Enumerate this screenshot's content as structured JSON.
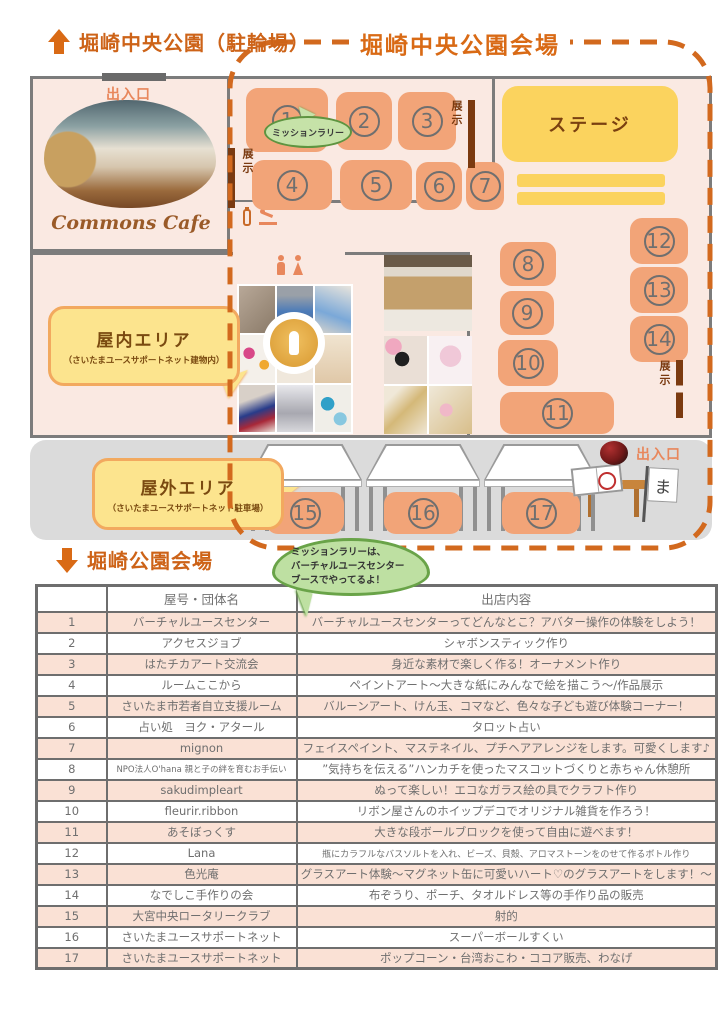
{
  "page": {
    "top_heading": "堀崎中央公園（駐輪場）",
    "map_title": "堀崎中央公園会場",
    "bottom_heading": "堀崎公園会場"
  },
  "map": {
    "entrance_label": "出入口",
    "exit_label": "出入口",
    "cafe_label": "Commons Cafe",
    "stage_label": "ステージ",
    "exhibit_label": "展示",
    "mission_bubble": "ミッションラリー",
    "indoor_bubble": {
      "title": "屋内エリア",
      "subtitle": "（さいたまユースサポートネット建物内）"
    },
    "outdoor_bubble": {
      "title": "屋外エリア",
      "subtitle": "（さいたまユースサポートネット駐車場）"
    },
    "flag_char": "ま",
    "booths": [
      "1",
      "2",
      "3",
      "4",
      "5",
      "6",
      "7",
      "8",
      "9",
      "10",
      "11",
      "12",
      "13",
      "14",
      "15",
      "16",
      "17"
    ]
  },
  "info_bubble": {
    "lines": [
      "ミッションラリーは、",
      "バーチャルユースセンター",
      "ブースでやってるよ！"
    ]
  },
  "table": {
    "headers": [
      "",
      "屋号・団体名",
      "出店内容"
    ],
    "rows": [
      {
        "no": "1",
        "name": "バーチャルユースセンター",
        "content": "バーチャルユースセンターってどんなとこ？アバター操作の体験をしよう！"
      },
      {
        "no": "2",
        "name": "アクセスジョブ",
        "content": "シャボンスティック作り"
      },
      {
        "no": "3",
        "name": "はたチカアート交流会",
        "content": "身近な素材で楽しく作る！オーナメント作り"
      },
      {
        "no": "4",
        "name": "ルームここから",
        "content": "ペイントアート～大きな紙にみんなで絵を描こう～/作品展示"
      },
      {
        "no": "5",
        "name": "さいたま市若者自立支援ルーム",
        "content": "バルーンアート、けん玉、コマなど、色々な子ども遊び体験コーナー！"
      },
      {
        "no": "6",
        "name": "占い処　ヨク・アタール",
        "content": "タロット占い"
      },
      {
        "no": "7",
        "name": "mignon",
        "content": "フェイスペイント、マステネイル、プチヘアアレンジをします。可愛くします♪"
      },
      {
        "no": "8",
        "name": "NPO法人O'hana 親と子の絆を育むお手伝い",
        "content": "”気持ちを伝える”ハンカチを使ったマスコットづくりと赤ちゃん休憩所"
      },
      {
        "no": "9",
        "name": "sakudimpleart",
        "content": "ぬって楽しい！エコなガラス絵の具でクラフト作り"
      },
      {
        "no": "10",
        "name": "fleurir.ribbon",
        "content": "リボン屋さんのホイップデコでオリジナル雑貨を作ろう！"
      },
      {
        "no": "11",
        "name": "あそぼっくす",
        "content": "大きな段ボールブロックを使って自由に遊べます！"
      },
      {
        "no": "12",
        "name": "Lana",
        "content": "瓶にカラフルなバスソルトを入れ、ビーズ、貝殻、アロマストーンをのせて作るボトル作り"
      },
      {
        "no": "13",
        "name": "色光庵",
        "content": "グラスアート体験～マグネット缶に可愛いハート♡のグラスアートをします！～"
      },
      {
        "no": "14",
        "name": "なでしこ手作りの会",
        "content": "布ぞうり、ポーチ、タオルドレス等の手作り品の販売"
      },
      {
        "no": "15",
        "name": "大宮中央ロータリークラブ",
        "content": "射的"
      },
      {
        "no": "16",
        "name": "さいたまユースサポートネット",
        "content": "スーパーボールすくい"
      },
      {
        "no": "17",
        "name": "さいたまユースサポートネット",
        "content": "ポップコーン・台湾おこわ・ココア販売、わなげ"
      }
    ]
  },
  "colors": {
    "accent_orange": "#d96a15",
    "dashed_border": "#d2691e",
    "booth_fill": "#f2a478",
    "stage_yellow": "#fbd35e",
    "bubble_yellow": "#fce48e",
    "bubble_green": "#bee0a2",
    "map_pink": "#fae9e2",
    "outdoor_gray": "#dbdbdb",
    "row_salmon": "#fae1d5",
    "exhibit_brown": "#7b3a10"
  }
}
